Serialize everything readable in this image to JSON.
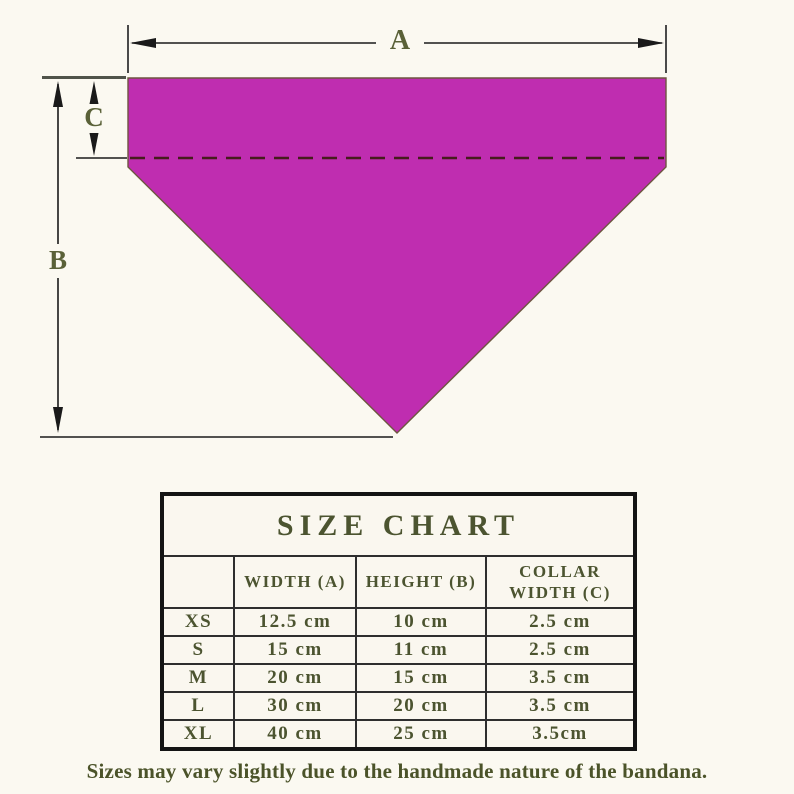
{
  "diagram": {
    "label_a": "A",
    "label_b": "B",
    "label_c": "C"
  },
  "colors": {
    "background": "#FBF9F1",
    "bandana_fill": "#BF2DB0",
    "bandana_outline": "#6E5640",
    "collar_dash": "#461C1C",
    "dimension_line": "#1A1A1A",
    "dimension_label": "#5A6138",
    "table_text": "#4C5430",
    "table_border": "#141414"
  },
  "size_chart": {
    "title": "SIZE CHART",
    "columns": {
      "size": "",
      "width": "WIDTH (A)",
      "height": "HEIGHT (B)",
      "collar": "COLLAR WIDTH (C)"
    },
    "rows": [
      {
        "size": "XS",
        "width": "12.5 cm",
        "height": "10 cm",
        "collar": "2.5 cm"
      },
      {
        "size": "S",
        "width": "15 cm",
        "height": "11 cm",
        "collar": "2.5 cm"
      },
      {
        "size": "M",
        "width": "20 cm",
        "height": "15 cm",
        "collar": "3.5 cm"
      },
      {
        "size": "L",
        "width": "30 cm",
        "height": "20 cm",
        "collar": "3.5 cm"
      },
      {
        "size": "XL",
        "width": "40 cm",
        "height": "25 cm",
        "collar": "3.5cm"
      }
    ]
  },
  "footer": {
    "note": "Sizes may vary slightly due to the handmade nature of the bandana."
  }
}
